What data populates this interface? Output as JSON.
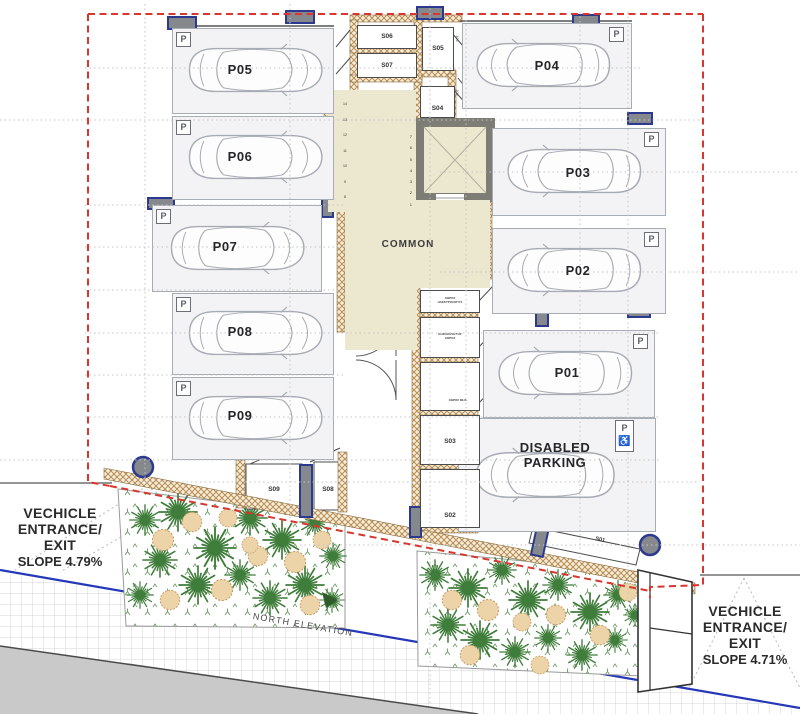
{
  "plan": {
    "parking_labels": [
      "P05",
      "P06",
      "P07",
      "P08",
      "P09",
      "P04",
      "P03",
      "P02",
      "P01"
    ],
    "disabled": {
      "line1": "DISABLED",
      "line2": "PARKING"
    },
    "sign_p": "P",
    "sign_wheelchair": "♿",
    "storage_labels": {
      "s01": "S01",
      "s02": "S02",
      "s03": "S03",
      "s04": "S04",
      "s05": "S05",
      "s06": "S06",
      "s07": "S07",
      "s08": "S08",
      "s09": "S09"
    },
    "common_label": "COMMON",
    "utility_labels": {
      "r1a": "ΧΩΡΟΣ",
      "r1b": "ΗΛΕΚΤΡΟΛΟΓΟΥ",
      "r2a": "ΚΟΙΝΟΧΡΗΣΤΟΣ",
      "r2b": "ΧΩΡΟΣ",
      "r3": "ΧΩΡΟΣ ΜΗΧ."
    },
    "door_tag": "102",
    "stairs": {
      "flight_right": [
        "7",
        "6",
        "5",
        "4",
        "3",
        "2",
        "1"
      ],
      "flight_left": [
        "14",
        "13",
        "12",
        "11",
        "10",
        "9",
        "8"
      ]
    },
    "entrance_left": {
      "l1": "VECHICLE",
      "l2": "ENTRANCE/",
      "l3": "EXIT",
      "slope": "SLOPE 4.79%"
    },
    "entrance_right": {
      "l1": "VECHICLE",
      "l2": "ENTRANCE/",
      "l3": "EXIT",
      "slope": "SLOPE 4.71%"
    },
    "north_elevation": "NORTH ELEVATION",
    "colors": {
      "boundary_red": "#d9362f",
      "column_blue": "#2b3a8f",
      "road_blue": "#2438b8",
      "wall_tan": "#b98c52",
      "floor_beige": "#ece7cf",
      "plant_green": "#3f7d3a",
      "shrub_tan": "#edd3a8"
    }
  }
}
